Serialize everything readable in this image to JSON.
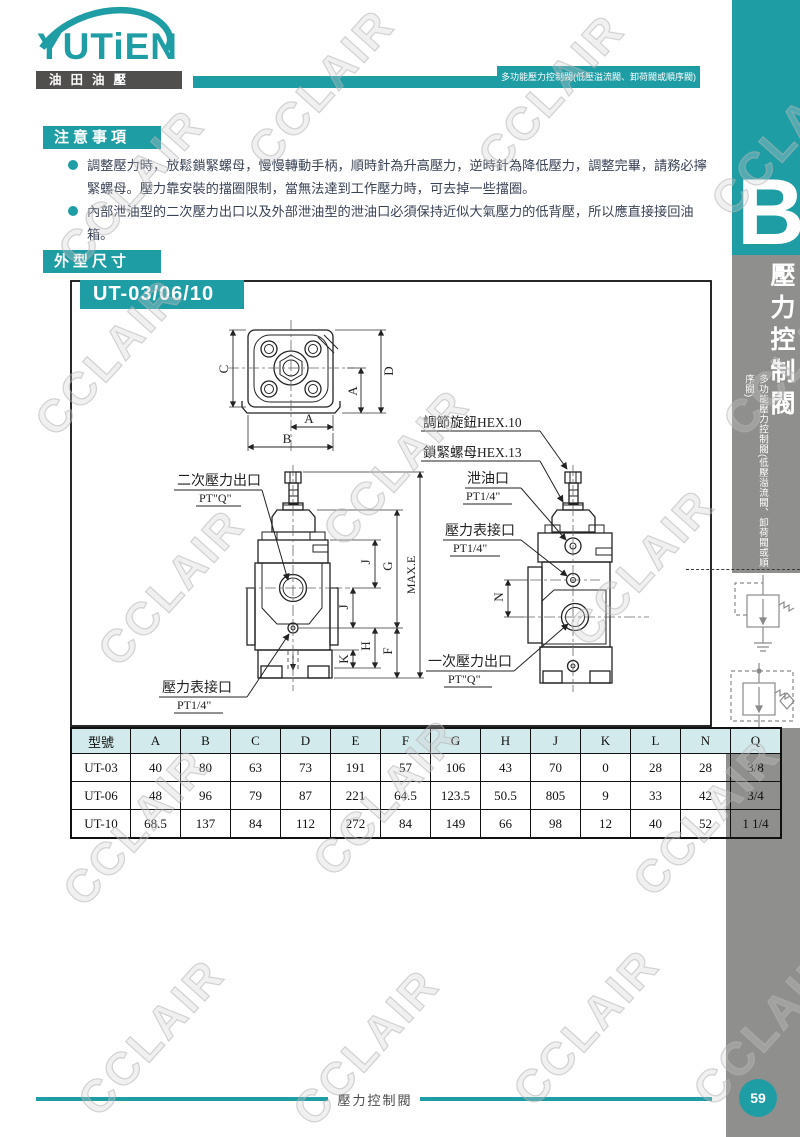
{
  "page": {
    "watermark": "CCLAIR"
  },
  "header": {
    "logo_text": "YUTiEN",
    "logo_subtext": "油田油壓",
    "banner": "多功能壓力控制閥(低壓溢流閥、卸荷閥或順序閥)"
  },
  "sidebar": {
    "section_letter": "B",
    "title_vertical": "壓力控制閥",
    "subtitle_vertical": "多功能壓力控制閥(低壓溢流閥、卸荷閥或順序閥)",
    "page_number": "59"
  },
  "notice": {
    "heading": "注意事項",
    "items": [
      "調整壓力時，放鬆鎖緊螺母，慢慢轉動手柄，順時針為升高壓力，逆時針為降低壓力，調整完畢，請務必擰緊螺母。壓力靠安裝的擋圈限制，當無法達到工作壓力時，可去掉一些擋圈。",
      "內部泄油型的二次壓力出口以及外部泄油型的泄油口必須保持近似大氣壓力的低背壓，所以應直接接回油箱。"
    ]
  },
  "dimensions_section": {
    "heading": "外型尺寸",
    "model": "UT-03/06/10"
  },
  "drawing": {
    "labels": {
      "secondary_outlet": "二次壓力出口",
      "secondary_outlet_size": "PT\"Q\"",
      "gauge_port_front": "壓力表接口",
      "gauge_port_front_size": "PT1/4\"",
      "adjust_knob": "調節旋鈕HEX.10",
      "lock_nut": "鎖緊螺母HEX.13",
      "drain_port": "泄油口",
      "drain_port_size": "PT1/4\"",
      "gauge_port_side": "壓力表接口",
      "gauge_port_side_size": "PT1/4\"",
      "primary_outlet": "一次壓力出口",
      "primary_outlet_size": "PT\"Q\""
    },
    "dims": {
      "a": "A",
      "b": "B",
      "c": "C",
      "d": "D",
      "max_e": "MAX.E",
      "f": "F",
      "g": "G",
      "h": "H",
      "j": "J",
      "k": "K",
      "n": "N"
    }
  },
  "table": {
    "columns": [
      "型號",
      "A",
      "B",
      "C",
      "D",
      "E",
      "F",
      "G",
      "H",
      "J",
      "K",
      "L",
      "N",
      "Q"
    ],
    "rows": [
      [
        "UT-03",
        "40",
        "80",
        "63",
        "73",
        "191",
        "57",
        "106",
        "43",
        "70",
        "0",
        "28",
        "28",
        "3/8"
      ],
      [
        "UT-06",
        "48",
        "96",
        "79",
        "87",
        "221",
        "64.5",
        "123.5",
        "50.5",
        "805",
        "9",
        "33",
        "42",
        "3/4"
      ],
      [
        "UT-10",
        "68.5",
        "137",
        "84",
        "112",
        "272",
        "84",
        "149",
        "66",
        "98",
        "12",
        "40",
        "52",
        "1 1/4"
      ]
    ]
  },
  "footer": {
    "title": "壓力控制閥"
  }
}
